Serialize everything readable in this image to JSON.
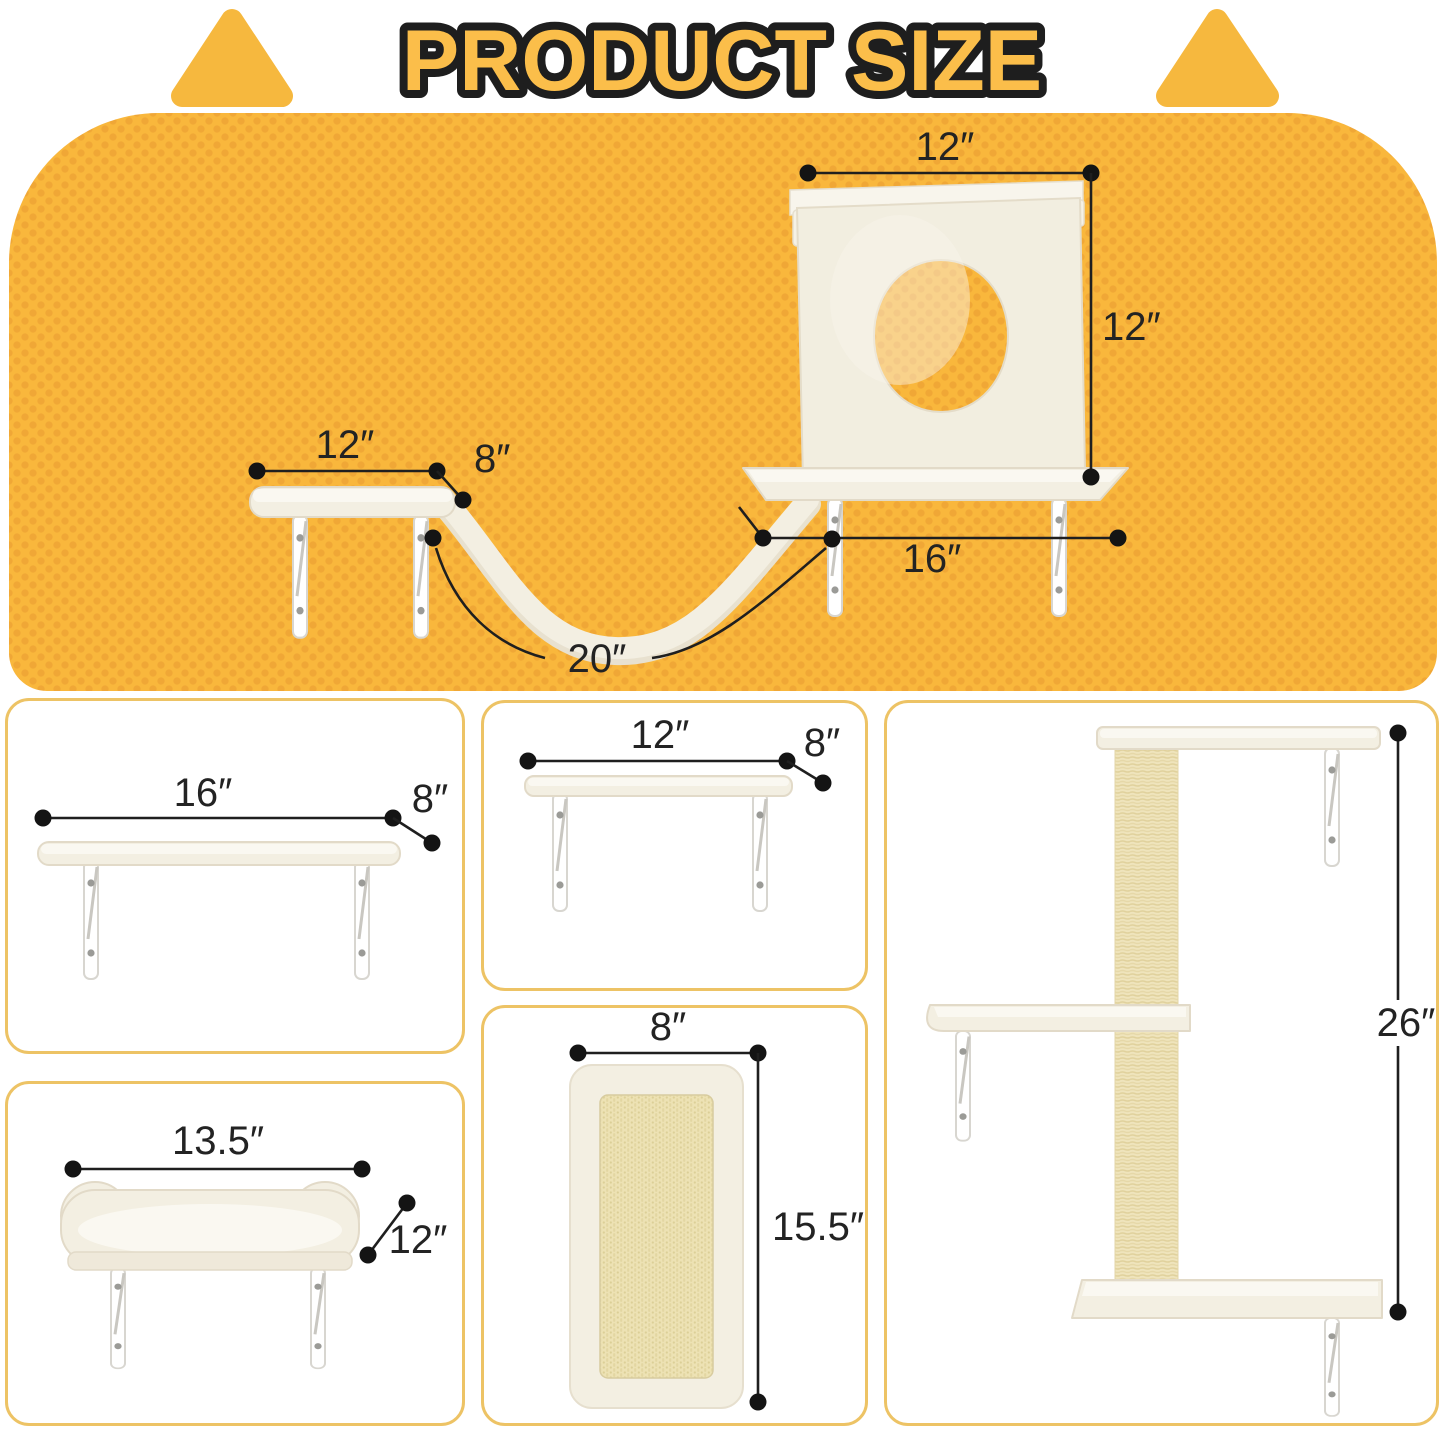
{
  "title": "PRODUCT SIZE",
  "colors": {
    "panel_background": "#F9B73C",
    "panel_dots": "#F0A736",
    "cell_border": "#EDC365",
    "title_fill": "#FBBE4A",
    "title_outline": "#1E1E1E",
    "dimension_ink": "#1F1F1F",
    "plush_cream": "#F3EFE2",
    "sisal_beige": "#EFE4BC",
    "bracket_metal": "#FFFFFF"
  },
  "main_diagram": {
    "house_width": "12″",
    "house_height": "12″",
    "small_shelf_width": "12″",
    "small_shelf_depth": "8″",
    "large_shelf_width": "16″",
    "bridge_length": "20″"
  },
  "cells": {
    "shelf_large": {
      "width": "16″",
      "depth": "8″"
    },
    "shelf_small": {
      "width": "12″",
      "depth": "8″"
    },
    "bed": {
      "width": "13.5″",
      "depth": "12″"
    },
    "scratcher": {
      "width": "8″",
      "height": "15.5″"
    },
    "tree": {
      "height": "26″"
    }
  }
}
